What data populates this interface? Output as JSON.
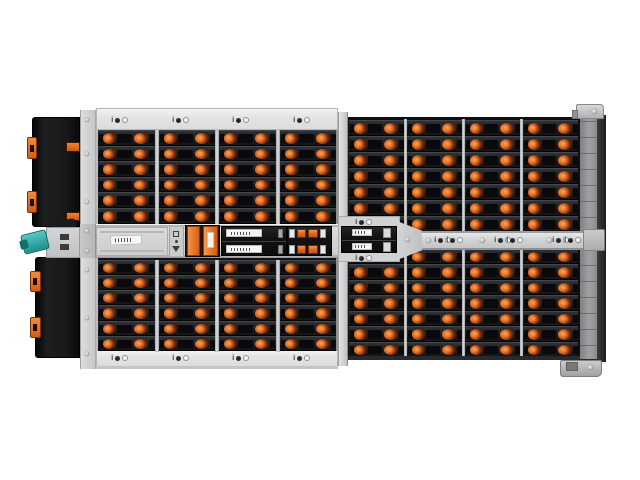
{
  "image": {
    "kind": "product-photo",
    "subject": "rack storage enclosure (JBOD) viewed from the top, drive bays with orange release latches",
    "background": "#ffffff"
  },
  "colors": {
    "latch_orange": "#e4641c",
    "latch_orange_hi": "#f9a75c",
    "latch_orange_mid": "#d25512",
    "latch_orange_dk": "#7e2d06",
    "bay_black": "#1a1b1d",
    "chassis_gray": "#d5d7d8",
    "band_gray": "#e4e6e6",
    "rail_dark": "#232426",
    "teal_connector": "#2fb3ae",
    "module_black": "#141416"
  },
  "indicator_glyph": "i",
  "left_bank": {
    "columns": 4,
    "rows_top": 6,
    "rows_bottom": 6,
    "drives_total": 48,
    "has_header_indicators": true,
    "has_footer_indicators": true
  },
  "right_bank": {
    "columns": 4,
    "rows_top": 7,
    "rows_bottom": 7,
    "drives_total": 56,
    "has_mid_rail_indicators": true,
    "mid_rail_indicator_pairs": 3
  },
  "center_tray": {
    "left_tray_label": "",
    "orange_handle_bars": 2,
    "black_module_label_rows": 2,
    "orange_connector_squares_per_row": 2,
    "center_module_label_rows": 2
  },
  "left_edge": {
    "psu_modules": 2,
    "orange_clips_per_module": 2,
    "teal_connector": true
  },
  "right_edge": {
    "rack_ear_top": true,
    "rack_ear_bottom": true
  }
}
